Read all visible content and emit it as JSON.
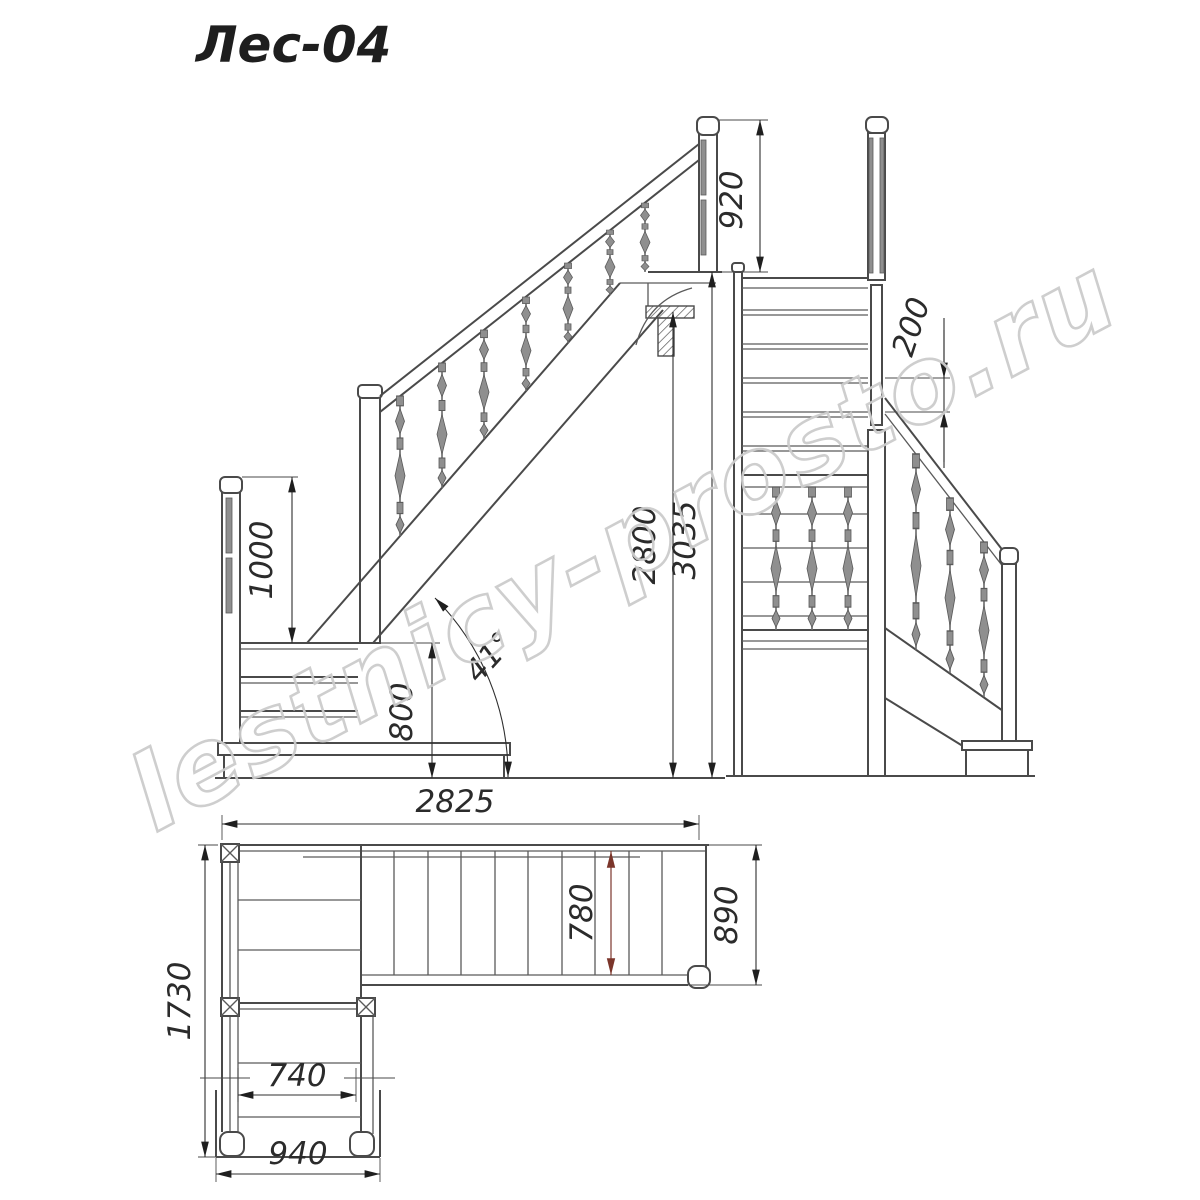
{
  "drawing": {
    "title": "Лес-04",
    "watermark": "lestnicy-prosto.ru",
    "angle_label": "41°",
    "dimensions": {
      "railing_height_upper": "920",
      "riser_height": "200",
      "railing_height_landing": "1000",
      "platform_height": "800",
      "floor_height": "2800",
      "total_height": "3035",
      "total_length": "2825",
      "flight_inner_width": "780",
      "flight_outer_width": "890",
      "plan_depth": "1730",
      "lower_flight_inner_width": "740",
      "lower_flight_outer_width": "940"
    },
    "colors": {
      "line": "#4a4a4a",
      "dimension": "#2f2f2f",
      "accent_red": "#7b352a",
      "baluster_gray": "#8f8f8f",
      "watermark_gray": "#cccccc",
      "background": "#ffffff"
    }
  }
}
